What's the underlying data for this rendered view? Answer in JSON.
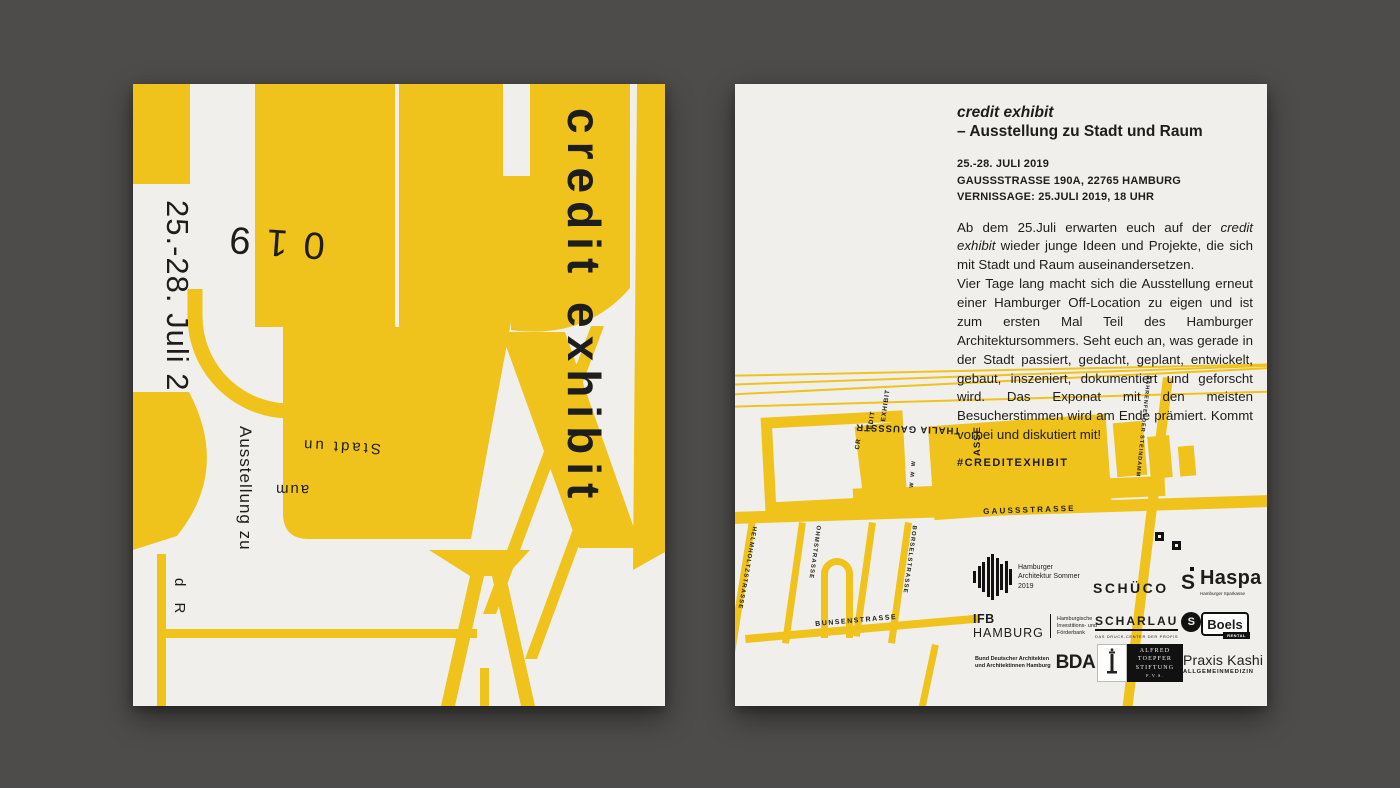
{
  "colors": {
    "background": "#4e4c4a",
    "paper": "#f0efec",
    "yellow": "#efc31c",
    "ink": "#1d1d1b"
  },
  "poster_left": {
    "date_vertical": "25.-28. Juli 2",
    "year_fragment": "019",
    "title_vertical": "credit exhibit",
    "fragment_ausstellung": "Ausstellung zu",
    "fragment_stadt": "Stadt un",
    "fragment_aum": "aum",
    "fragment_dr": "d R"
  },
  "poster_right": {
    "title": "credit exhibit",
    "subtitle": "– Ausstellung zu Stadt und Raum",
    "info_line1": "25.-28. JULI 2019",
    "info_line2": "GAUSSSTRASSE 190A, 22765 HAMBURG",
    "info_line3": "VERNISSAGE: 25.JULI 2019, 18 UHR",
    "body_p1_before": "Ab dem 25.Juli erwarten euch auf der ",
    "body_p1_italic": "credit exhibit",
    "body_p1_after": " wieder junge Ideen und Projekte, die sich mit Stadt und Raum auseinandersetzen.",
    "body_p2": "Vier Tage lang macht sich die Ausstellung erneut einer Hamburger Off-Location zu eigen und ist zum ersten Mal Teil des Hamburger Architektursommers. Seht euch an, was gerade in der Stadt passiert, gedacht, geplant, entwickelt, gebaut, inszeniert, dokumentiert und geforscht wird. Das Exponat mit den meisten Besucherstimmen wird am Ende prämiert. Kommt vorbei und diskutiert mit!",
    "hashtag": "#CREDITEXHIBIT",
    "map": {
      "street_gauss": "GAUSSSTRASSE",
      "street_bahrenfelder": "BAHRENFELDER STEINDAMM",
      "street_helmholtz": "HELMHOLTZSTRASSE",
      "street_ohm": "OHMSTRASSE",
      "street_borsel": "BORSELSTRASSE",
      "street_bunsen": "BUNSENSTRASSE",
      "building_thalia_line1": "THALIA GAUSSSTR",
      "building_thalia_line2": "ASSE",
      "venue_cr": "CR",
      "venue_edit": "EDIT",
      "venue_exhibit": "EXHIBIT",
      "markers": "W W W"
    },
    "sponsors": {
      "archsommer_line1": "Hamburger",
      "archsommer_line2": "Architektur Sommer",
      "archsommer_line3": "2019",
      "schueco": "SCHÜCO",
      "haspa_icon": "S",
      "haspa_name": "Haspa",
      "haspa_sub": "Hamburger Sparkasse",
      "ifb_name1": "IFB",
      "ifb_name2": "HAMBURG",
      "ifb_desc1": "Hamburgische",
      "ifb_desc2": "Investitions- und",
      "ifb_desc3": "Förderbank",
      "scharlau_name": "SCHARLAU",
      "scharlau_icon": "S",
      "scharlau_sub": "DAS DRUCK-CENTER DER PROFIS",
      "boels_name": "Boels",
      "boels_sub": "RENTAL",
      "bda_desc1": "Bund Deutscher Architekten",
      "bda_desc2": "und Architektinnen Hamburg",
      "bda_name": "BDA",
      "toepfer_line1": "ALFRED",
      "toepfer_line2": "TOEPFER",
      "toepfer_line3": "STIFTUNG",
      "toepfer_line4": "F.V.S.",
      "kashi_name": "Praxis Kashi",
      "kashi_sub": "ALLGEMEINMEDIZIN"
    }
  }
}
